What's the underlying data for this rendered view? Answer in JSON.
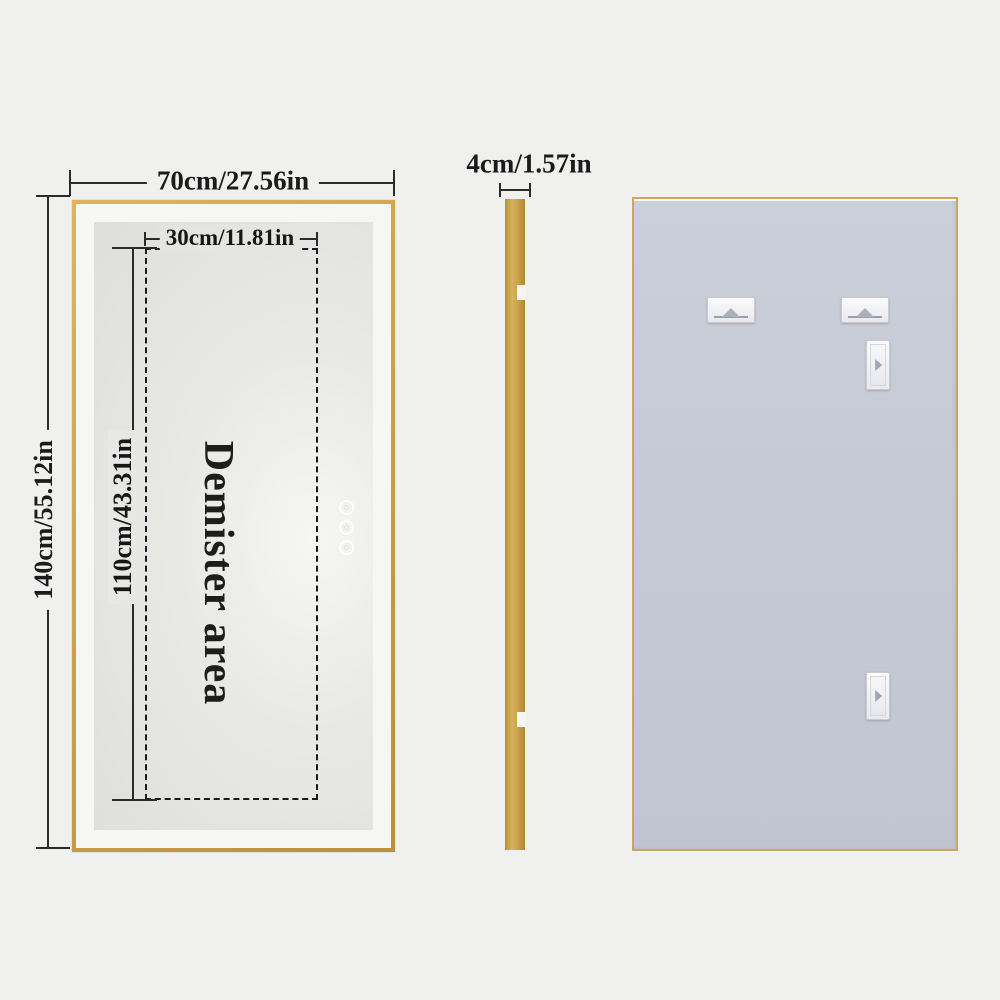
{
  "front_view": {
    "width_label": "70cm/27.56in",
    "height_label": "140cm/55.12in",
    "demister_label": "Demister area",
    "demister_width_label": "30cm/11.81in",
    "demister_height_label": "110cm/43.31in",
    "touch_button_count": 3
  },
  "side_view": {
    "thickness_label": "4cm/1.57in"
  },
  "back_view": {
    "mount_slot_count": 4
  },
  "colors": {
    "background": "#f0f0ef",
    "frame_gold": "#cfa24a",
    "mirror_face": "#f6f6f4",
    "mirror_panel": "#e7e7e5",
    "back_panel": "#c6cad5",
    "dimension_line": "#2b2b2b",
    "text": "#1b1b1b"
  }
}
